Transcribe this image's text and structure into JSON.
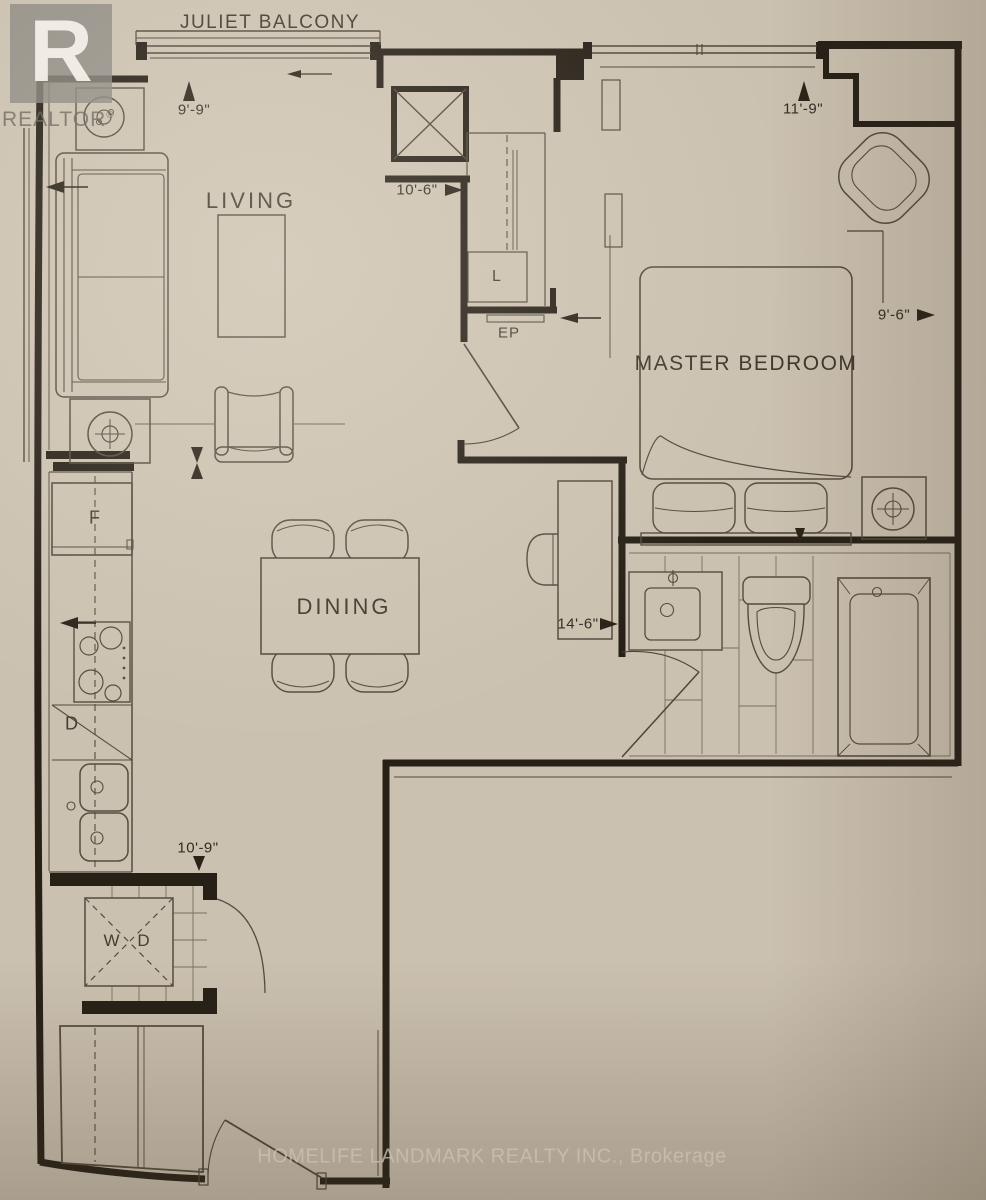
{
  "rooms": {
    "juliet_balcony": "JULIET BALCONY",
    "living": "LIVING",
    "dining": "DINING",
    "master_bedroom": "MASTER BEDROOM"
  },
  "fixtures": {
    "linen_closet": "L",
    "electrical_panel": "EP",
    "fridge": "F",
    "dishwasher": "D",
    "washer": "W",
    "dryer": "D"
  },
  "dimensions": {
    "living_depth": "9'-9\"",
    "living_width": "10'-6\"",
    "bedroom_width": "11'-9\"",
    "bedroom_depth": "9'-6\"",
    "unit_width": "14'-6\"",
    "kitchen_run": "10'-9\""
  },
  "watermarks": {
    "logo_letter": "R",
    "logo_word": "REALTOR",
    "logo_reg": "®",
    "brokerage": "HOMELIFE LANDMARK REALTY INC., Brokerage"
  },
  "colors": {
    "paper": "#cbc1b0",
    "wall_line": "#272017",
    "furniture_line": "#554c40",
    "label_text": "#3f382d",
    "watermark_gray": "#8a8680"
  }
}
